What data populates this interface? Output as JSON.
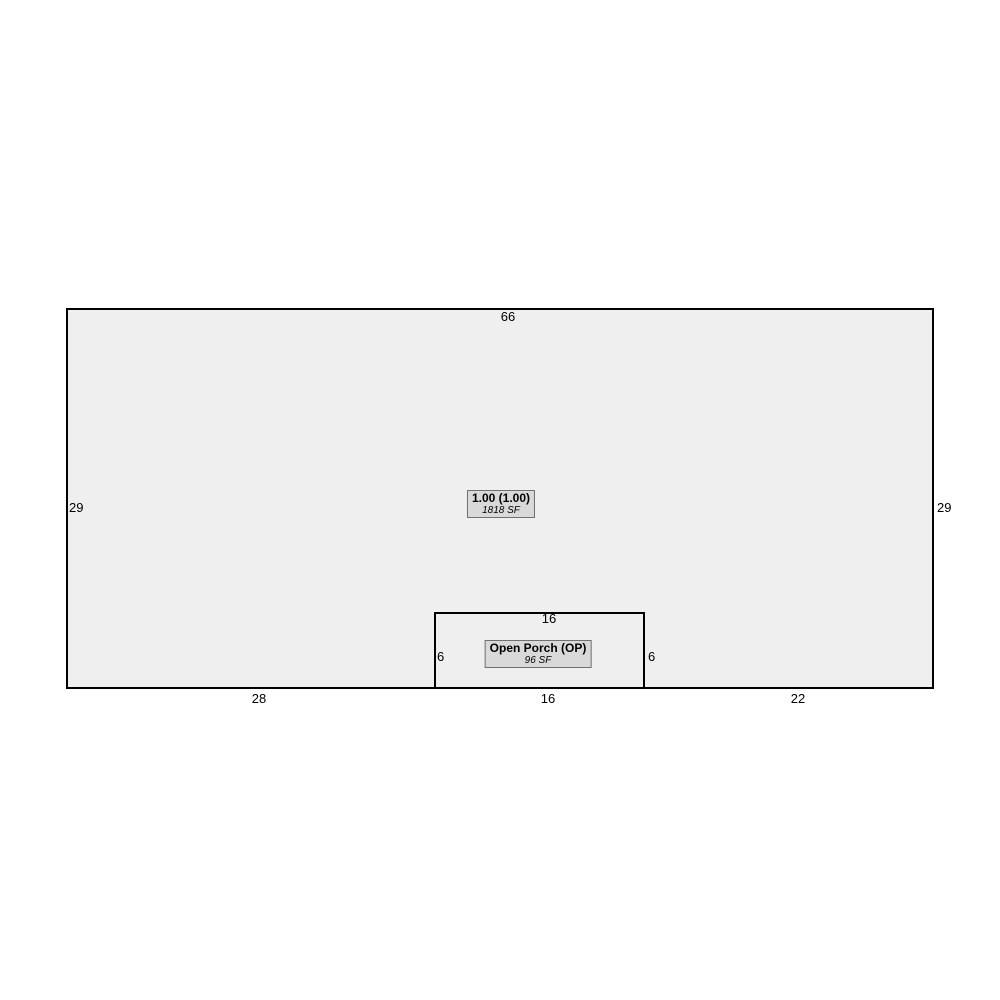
{
  "sketch": {
    "main_building": {
      "label_line1": "1.00 (1.00)",
      "label_line2": "1818 SF",
      "dims": {
        "top": "66",
        "left": "29",
        "right": "29",
        "bottom_left": "28",
        "bottom_center": "16",
        "bottom_right": "22"
      }
    },
    "porch": {
      "label_line1": "Open Porch (OP)",
      "label_line2": "96 SF",
      "dims": {
        "top": "16",
        "left": "6",
        "right": "6"
      }
    },
    "colors": {
      "page_bg": "#ffffff",
      "area_fill": "#efefef",
      "outline": "#000000",
      "label_box_fill": "#d9d9d9",
      "label_box_border": "#707070",
      "text": "#000000"
    }
  }
}
